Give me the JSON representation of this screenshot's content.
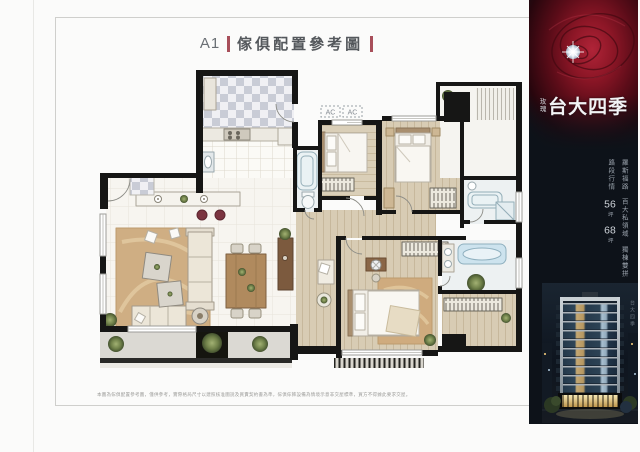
{
  "title": {
    "prefix": "A1",
    "text": "傢俱配置參考圖",
    "bar_color": "#a84f5a"
  },
  "plan": {
    "ac_label": "AC"
  },
  "disclaimer": "本圖為傢俱配置參考圖，僅供參考，實際格局尺寸以建照核准圖說及買賣契約書為準，傢俱傢飾設備為情境示意非交屋標準，買方不得據此要求交屋。",
  "panel": {
    "bg_color": "#0d1219",
    "brand": {
      "small": "玫瑰",
      "main": "台大四季"
    },
    "tagline": [
      "羅斯福路",
      "百大私領域",
      "獨棟雙拼",
      "路段行情"
    ],
    "sizes": [
      {
        "num": "56",
        "unit": "坪"
      },
      {
        "num": "68",
        "unit": "坪"
      }
    ],
    "photo_caption": "台大四季"
  }
}
